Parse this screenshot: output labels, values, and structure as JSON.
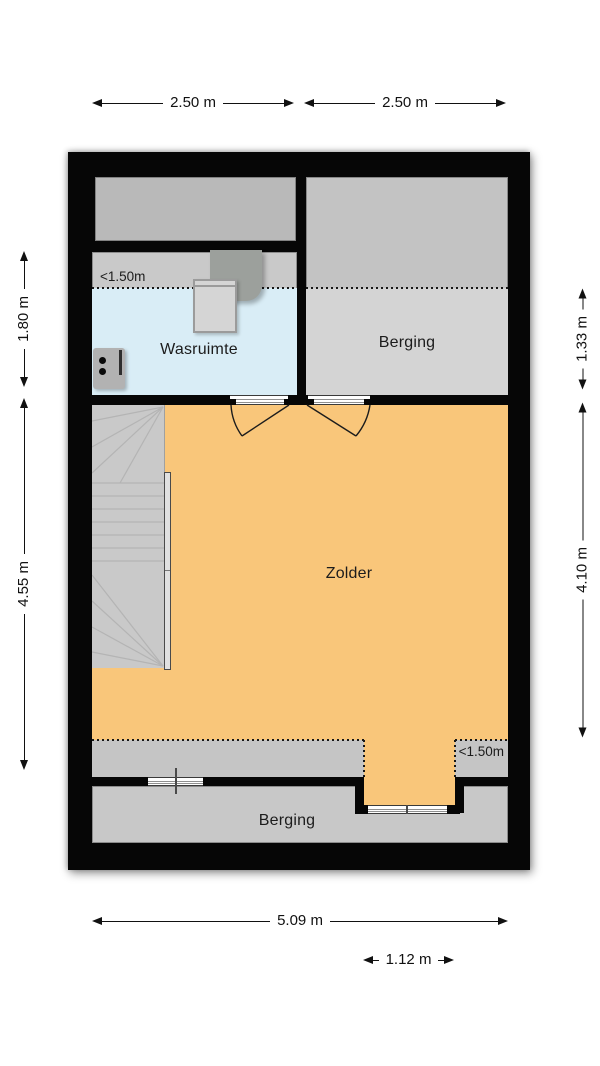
{
  "plan": {
    "rooms": {
      "wasruimte": {
        "label": "Wasruimte"
      },
      "berging_top": {
        "label": "Berging"
      },
      "zolder": {
        "label": "Zolder"
      },
      "berging_bottom": {
        "label": "Berging"
      }
    },
    "annotations": {
      "low_ceiling_wasruimte": "<1.50m",
      "low_ceiling_zolder": "<1.50m"
    },
    "dimensions": {
      "top_left": "2.50 m",
      "top_right": "2.50 m",
      "left_upper": "1.80 m",
      "left_lower": "4.55 m",
      "right_upper": "1.33 m",
      "right_lower": "4.10 m",
      "bottom_width": "5.09 m",
      "bottom_dormer": "1.12 m"
    },
    "colors": {
      "wall": "#060606",
      "zolder_floor": "#f9c67a",
      "wasruimte_floor": "#d9edf6",
      "gray_room_upper": "#c3c3c3",
      "gray_room_lower": "#d4d4d4",
      "gray_low_zone": "#c5c5c5",
      "stairs": "#c9c9c9",
      "storage_box": "#b9b9b9"
    }
  }
}
